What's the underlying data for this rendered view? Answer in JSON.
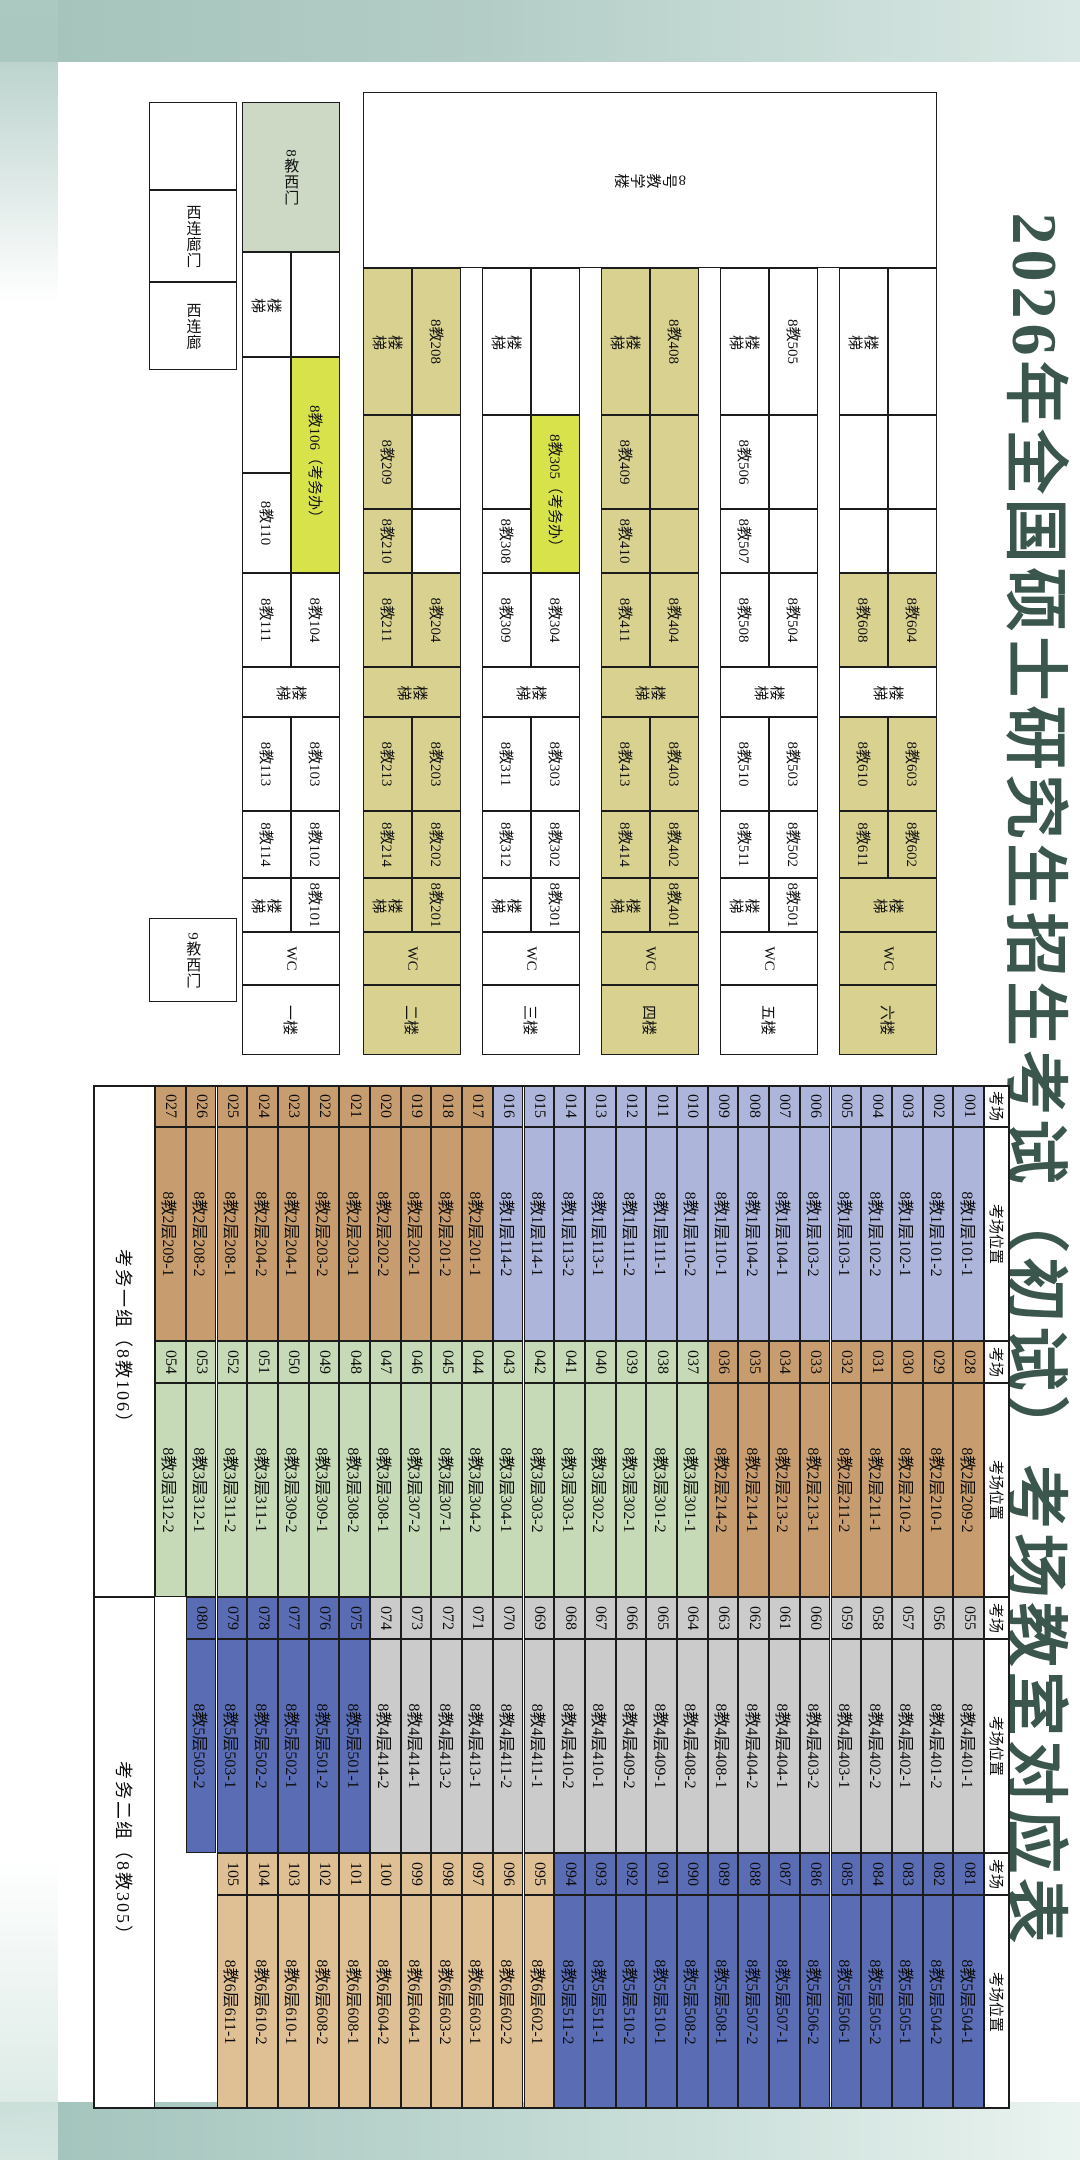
{
  "title": "2026年全国硕士研究生招生考试（初试）考场教室对应表",
  "colors": {
    "title": "#3b564c",
    "khaki": "#d8d190",
    "white": "#ffffff",
    "bright_yellow": "#d8e34c",
    "sage_green": "#cdd8c5",
    "floor1": "#aeb5db",
    "floor2": "#c79d70",
    "floor3": "#c6dab7",
    "floor4": "#cbcbcb",
    "floor5": "#5a6cb4",
    "floor6": "#dfbf94"
  },
  "plan": {
    "building_label": "8号教学楼",
    "cells": [
      [
        92,
        143,
        176,
        574,
        "8号教学楼",
        "w",
        "v"
      ],
      [
        268,
        143,
        147,
        49,
        "",
        "w",
        "h"
      ],
      [
        268,
        192,
        147,
        49,
        "楼梯",
        "w",
        "v"
      ],
      [
        415,
        143,
        94,
        49,
        "",
        "w",
        "h"
      ],
      [
        415,
        192,
        94,
        49,
        "",
        "w",
        "h"
      ],
      [
        509,
        143,
        64,
        49,
        "",
        "w",
        "h"
      ],
      [
        509,
        192,
        64,
        49,
        "",
        "w",
        "h"
      ],
      [
        573,
        143,
        94,
        49,
        "8教604",
        "k",
        "h"
      ],
      [
        573,
        192,
        94,
        49,
        "8教608",
        "k",
        "h"
      ],
      [
        667,
        143,
        50,
        98,
        "楼梯",
        "w",
        "v"
      ],
      [
        717,
        143,
        94,
        49,
        "8教603",
        "k",
        "h"
      ],
      [
        717,
        192,
        94,
        49,
        "8教610",
        "k",
        "h"
      ],
      [
        811,
        143,
        67,
        49,
        "8教602",
        "k",
        "h"
      ],
      [
        811,
        192,
        67,
        49,
        "8教611",
        "k",
        "h"
      ],
      [
        878,
        143,
        54,
        98,
        "楼梯",
        "k",
        "v"
      ],
      [
        932,
        143,
        53,
        98,
        "WC",
        "k",
        "h"
      ],
      [
        985,
        143,
        70,
        98,
        "六楼",
        "k",
        "h"
      ],
      [
        268,
        262,
        147,
        49,
        "8教505",
        "w",
        "h"
      ],
      [
        268,
        311,
        147,
        49,
        "楼梯",
        "w",
        "v"
      ],
      [
        415,
        262,
        94,
        49,
        "",
        "w",
        "h"
      ],
      [
        415,
        311,
        94,
        49,
        "8教506",
        "w",
        "h"
      ],
      [
        509,
        262,
        64,
        49,
        "",
        "w",
        "h"
      ],
      [
        509,
        311,
        64,
        49,
        "8教507",
        "w",
        "h"
      ],
      [
        573,
        262,
        94,
        49,
        "8教504",
        "w",
        "h"
      ],
      [
        573,
        311,
        94,
        49,
        "8教508",
        "w",
        "h"
      ],
      [
        667,
        262,
        50,
        98,
        "楼梯",
        "w",
        "v"
      ],
      [
        717,
        262,
        94,
        49,
        "8教503",
        "w",
        "h"
      ],
      [
        717,
        311,
        94,
        49,
        "8教510",
        "w",
        "h"
      ],
      [
        811,
        262,
        67,
        49,
        "8教502",
        "w",
        "h"
      ],
      [
        811,
        311,
        67,
        49,
        "8教511",
        "w",
        "h"
      ],
      [
        878,
        262,
        54,
        49,
        "8教501",
        "w",
        "h"
      ],
      [
        878,
        311,
        54,
        49,
        "楼梯",
        "w",
        "v"
      ],
      [
        932,
        262,
        53,
        98,
        "WC",
        "w",
        "h"
      ],
      [
        985,
        262,
        70,
        98,
        "五楼",
        "w",
        "h"
      ],
      [
        268,
        381,
        147,
        49,
        "8教408",
        "k",
        "h"
      ],
      [
        268,
        430,
        147,
        49,
        "楼梯",
        "k",
        "v"
      ],
      [
        415,
        381,
        94,
        49,
        "",
        "k",
        "h"
      ],
      [
        415,
        430,
        94,
        49,
        "8教409",
        "k",
        "h"
      ],
      [
        509,
        381,
        64,
        49,
        "",
        "k",
        "h"
      ],
      [
        509,
        430,
        64,
        49,
        "8教410",
        "k",
        "h"
      ],
      [
        573,
        381,
        94,
        49,
        "8教404",
        "k",
        "h"
      ],
      [
        573,
        430,
        94,
        49,
        "8教411",
        "k",
        "h"
      ],
      [
        667,
        381,
        50,
        98,
        "楼梯",
        "k",
        "v"
      ],
      [
        717,
        381,
        94,
        49,
        "8教403",
        "k",
        "h"
      ],
      [
        717,
        430,
        94,
        49,
        "8教413",
        "k",
        "h"
      ],
      [
        811,
        381,
        67,
        49,
        "8教402",
        "k",
        "h"
      ],
      [
        811,
        430,
        67,
        49,
        "8教414",
        "k",
        "h"
      ],
      [
        878,
        381,
        54,
        49,
        "8教401",
        "k",
        "h"
      ],
      [
        878,
        430,
        54,
        49,
        "楼梯",
        "k",
        "v"
      ],
      [
        932,
        381,
        53,
        98,
        "WC",
        "k",
        "h"
      ],
      [
        985,
        381,
        70,
        98,
        "四楼",
        "k",
        "h"
      ],
      [
        268,
        500,
        147,
        49,
        "",
        "w",
        "h"
      ],
      [
        268,
        549,
        147,
        49,
        "楼梯",
        "w",
        "v"
      ],
      [
        415,
        500,
        158,
        49,
        "8教305（考务办）",
        "y",
        "h"
      ],
      [
        415,
        549,
        94,
        49,
        "",
        "w",
        "h"
      ],
      [
        509,
        549,
        64,
        49,
        "8教308",
        "w",
        "h"
      ],
      [
        573,
        500,
        94,
        49,
        "8教304",
        "w",
        "h"
      ],
      [
        573,
        549,
        94,
        49,
        "8教309",
        "w",
        "h"
      ],
      [
        667,
        500,
        50,
        98,
        "楼梯",
        "w",
        "v"
      ],
      [
        717,
        500,
        94,
        49,
        "8教303",
        "w",
        "h"
      ],
      [
        717,
        549,
        94,
        49,
        "8教311",
        "w",
        "h"
      ],
      [
        811,
        500,
        67,
        49,
        "8教302",
        "w",
        "h"
      ],
      [
        811,
        549,
        67,
        49,
        "8教312",
        "w",
        "h"
      ],
      [
        878,
        500,
        54,
        49,
        "8教301",
        "w",
        "h"
      ],
      [
        878,
        549,
        54,
        49,
        "楼梯",
        "w",
        "v"
      ],
      [
        932,
        500,
        53,
        98,
        "WC",
        "w",
        "h"
      ],
      [
        985,
        500,
        70,
        98,
        "三楼",
        "w",
        "h"
      ],
      [
        268,
        619,
        147,
        49,
        "8教208",
        "k",
        "h"
      ],
      [
        268,
        668,
        147,
        49,
        "楼梯",
        "k",
        "v"
      ],
      [
        415,
        619,
        94,
        49,
        "",
        "w",
        "h"
      ],
      [
        415,
        668,
        94,
        49,
        "8教209",
        "k",
        "h"
      ],
      [
        509,
        619,
        64,
        49,
        "",
        "w",
        "h"
      ],
      [
        509,
        668,
        64,
        49,
        "8教210",
        "k",
        "h"
      ],
      [
        573,
        619,
        94,
        49,
        "8教204",
        "k",
        "h"
      ],
      [
        573,
        668,
        94,
        49,
        "8教211",
        "k",
        "h"
      ],
      [
        667,
        619,
        50,
        98,
        "楼梯",
        "k",
        "v"
      ],
      [
        717,
        619,
        94,
        49,
        "8教203",
        "k",
        "h"
      ],
      [
        717,
        668,
        94,
        49,
        "8教213",
        "k",
        "h"
      ],
      [
        811,
        619,
        67,
        49,
        "8教202",
        "k",
        "h"
      ],
      [
        811,
        668,
        67,
        49,
        "8教214",
        "k",
        "h"
      ],
      [
        878,
        619,
        54,
        49,
        "8教201",
        "k",
        "h"
      ],
      [
        878,
        668,
        54,
        49,
        "楼梯",
        "k",
        "v"
      ],
      [
        932,
        619,
        53,
        98,
        "WC",
        "k",
        "h"
      ],
      [
        985,
        619,
        70,
        98,
        "二楼",
        "k",
        "h"
      ],
      [
        102,
        740,
        150,
        98,
        "8教西门",
        "g",
        "r"
      ],
      [
        252,
        740,
        105,
        49,
        "",
        "w",
        "h"
      ],
      [
        252,
        789,
        105,
        49,
        "楼梯",
        "w",
        "v"
      ],
      [
        357,
        740,
        216,
        49,
        "8教106（考务办）",
        "y",
        "h"
      ],
      [
        357,
        789,
        116,
        49,
        "",
        "w",
        "h"
      ],
      [
        473,
        789,
        100,
        49,
        "8教110",
        "w",
        "h"
      ],
      [
        573,
        740,
        94,
        49,
        "8教104",
        "w",
        "h"
      ],
      [
        573,
        789,
        94,
        49,
        "8教111",
        "w",
        "h"
      ],
      [
        667,
        740,
        50,
        98,
        "楼梯",
        "w",
        "v"
      ],
      [
        717,
        740,
        94,
        49,
        "8教103",
        "w",
        "h"
      ],
      [
        717,
        789,
        94,
        49,
        "8教113",
        "w",
        "h"
      ],
      [
        811,
        740,
        67,
        49,
        "8教102",
        "w",
        "h"
      ],
      [
        811,
        789,
        67,
        49,
        "8教114",
        "w",
        "h"
      ],
      [
        878,
        740,
        54,
        49,
        "8教101",
        "w",
        "h"
      ],
      [
        878,
        789,
        54,
        49,
        "楼梯",
        "w",
        "v"
      ],
      [
        932,
        740,
        53,
        98,
        "WC",
        "w",
        "h"
      ],
      [
        985,
        740,
        70,
        98,
        "一楼",
        "w",
        "h"
      ],
      [
        102,
        843,
        88,
        88,
        "",
        "w",
        "h"
      ],
      [
        190,
        843,
        92,
        88,
        "西连廊门",
        "w",
        "r"
      ],
      [
        282,
        843,
        88,
        88,
        "西连廊",
        "w",
        "r"
      ],
      [
        918,
        843,
        84,
        88,
        "9教西门",
        "w",
        "r"
      ]
    ]
  },
  "table": {
    "header_room": "考场",
    "header_location": "考场位置",
    "footer": [
      "考务一组（8教106）",
      "考务二组（8教305）"
    ],
    "pairs": [
      [
        [
          "001",
          "8教1层101-1"
        ],
        [
          "002",
          "8教1层101-2"
        ],
        [
          "003",
          "8教1层102-1"
        ],
        [
          "004",
          "8教1层102-2"
        ],
        [
          "005",
          "8教1层103-1"
        ],
        [
          "006",
          "8教1层103-2"
        ],
        [
          "007",
          "8教1层104-1"
        ],
        [
          "008",
          "8教1层104-2"
        ],
        [
          "009",
          "8教1层110-1"
        ],
        [
          "010",
          "8教1层110-2"
        ],
        [
          "011",
          "8教1层111-1"
        ],
        [
          "012",
          "8教1层111-2"
        ],
        [
          "013",
          "8教1层113-1"
        ],
        [
          "014",
          "8教1层113-2"
        ],
        [
          "015",
          "8教1层114-1"
        ],
        [
          "016",
          "8教1层114-2"
        ],
        [
          "017",
          "8教2层201-1"
        ],
        [
          "018",
          "8教2层201-2"
        ],
        [
          "019",
          "8教2层202-1"
        ],
        [
          "020",
          "8教2层202-2"
        ],
        [
          "021",
          "8教2层203-1"
        ],
        [
          "022",
          "8教2层203-2"
        ],
        [
          "023",
          "8教2层204-1"
        ],
        [
          "024",
          "8教2层204-2"
        ],
        [
          "025",
          "8教2层208-1"
        ],
        [
          "026",
          "8教2层208-2"
        ],
        [
          "027",
          "8教2层209-1"
        ]
      ],
      [
        [
          "028",
          "8教2层209-2"
        ],
        [
          "029",
          "8教2层210-1"
        ],
        [
          "030",
          "8教2层210-2"
        ],
        [
          "031",
          "8教2层211-1"
        ],
        [
          "032",
          "8教2层211-2"
        ],
        [
          "033",
          "8教2层213-1"
        ],
        [
          "034",
          "8教2层213-2"
        ],
        [
          "035",
          "8教2层214-1"
        ],
        [
          "036",
          "8教2层214-2"
        ],
        [
          "037",
          "8教3层301-1"
        ],
        [
          "038",
          "8教3层301-2"
        ],
        [
          "039",
          "8教3层302-1"
        ],
        [
          "040",
          "8教3层302-2"
        ],
        [
          "041",
          "8教3层303-1"
        ],
        [
          "042",
          "8教3层303-2"
        ],
        [
          "043",
          "8教3层304-1"
        ],
        [
          "044",
          "8教3层304-2"
        ],
        [
          "045",
          "8教3层307-1"
        ],
        [
          "046",
          "8教3层307-2"
        ],
        [
          "047",
          "8教3层308-1"
        ],
        [
          "048",
          "8教3层308-2"
        ],
        [
          "049",
          "8教3层309-1"
        ],
        [
          "050",
          "8教3层309-2"
        ],
        [
          "051",
          "8教3层311-1"
        ],
        [
          "052",
          "8教3层311-2"
        ],
        [
          "053",
          "8教3层312-1"
        ],
        [
          "054",
          "8教3层312-2"
        ]
      ],
      [
        [
          "055",
          "8教4层401-1"
        ],
        [
          "056",
          "8教4层401-2"
        ],
        [
          "057",
          "8教4层402-1"
        ],
        [
          "058",
          "8教4层402-2"
        ],
        [
          "059",
          "8教4层403-1"
        ],
        [
          "060",
          "8教4层403-2"
        ],
        [
          "061",
          "8教4层404-1"
        ],
        [
          "062",
          "8教4层404-2"
        ],
        [
          "063",
          "8教4层408-1"
        ],
        [
          "064",
          "8教4层408-2"
        ],
        [
          "065",
          "8教4层409-1"
        ],
        [
          "066",
          "8教4层409-2"
        ],
        [
          "067",
          "8教4层410-1"
        ],
        [
          "068",
          "8教4层410-2"
        ],
        [
          "069",
          "8教4层411-1"
        ],
        [
          "070",
          "8教4层411-2"
        ],
        [
          "071",
          "8教4层413-1"
        ],
        [
          "072",
          "8教4层413-2"
        ],
        [
          "073",
          "8教4层414-1"
        ],
        [
          "074",
          "8教4层414-2"
        ],
        [
          "075",
          "8教5层501-1"
        ],
        [
          "076",
          "8教5层501-2"
        ],
        [
          "077",
          "8教5层502-1"
        ],
        [
          "078",
          "8教5层502-2"
        ],
        [
          "079",
          "8教5层503-1"
        ],
        [
          "080",
          "8教5层503-2"
        ]
      ],
      [
        [
          "081",
          "8教5层504-1"
        ],
        [
          "082",
          "8教5层504-2"
        ],
        [
          "083",
          "8教5层505-1"
        ],
        [
          "084",
          "8教5层505-2"
        ],
        [
          "085",
          "8教5层506-1"
        ],
        [
          "086",
          "8教5层506-2"
        ],
        [
          "087",
          "8教5层507-1"
        ],
        [
          "088",
          "8教5层507-2"
        ],
        [
          "089",
          "8教5层508-1"
        ],
        [
          "090",
          "8教5层508-2"
        ],
        [
          "091",
          "8教5层510-1"
        ],
        [
          "092",
          "8教5层510-2"
        ],
        [
          "093",
          "8教5层511-1"
        ],
        [
          "094",
          "8教5层511-2"
        ],
        [
          "095",
          "8教6层602-1"
        ],
        [
          "096",
          "8教6层602-2"
        ],
        [
          "097",
          "8教6层603-1"
        ],
        [
          "098",
          "8教6层603-2"
        ],
        [
          "099",
          "8教6层604-1"
        ],
        [
          "100",
          "8教6层604-2"
        ],
        [
          "101",
          "8教6层608-1"
        ],
        [
          "102",
          "8教6层608-2"
        ],
        [
          "103",
          "8教6层610-1"
        ],
        [
          "104",
          "8教6层610-2"
        ],
        [
          "105",
          "8教6层611-1"
        ]
      ]
    ]
  }
}
